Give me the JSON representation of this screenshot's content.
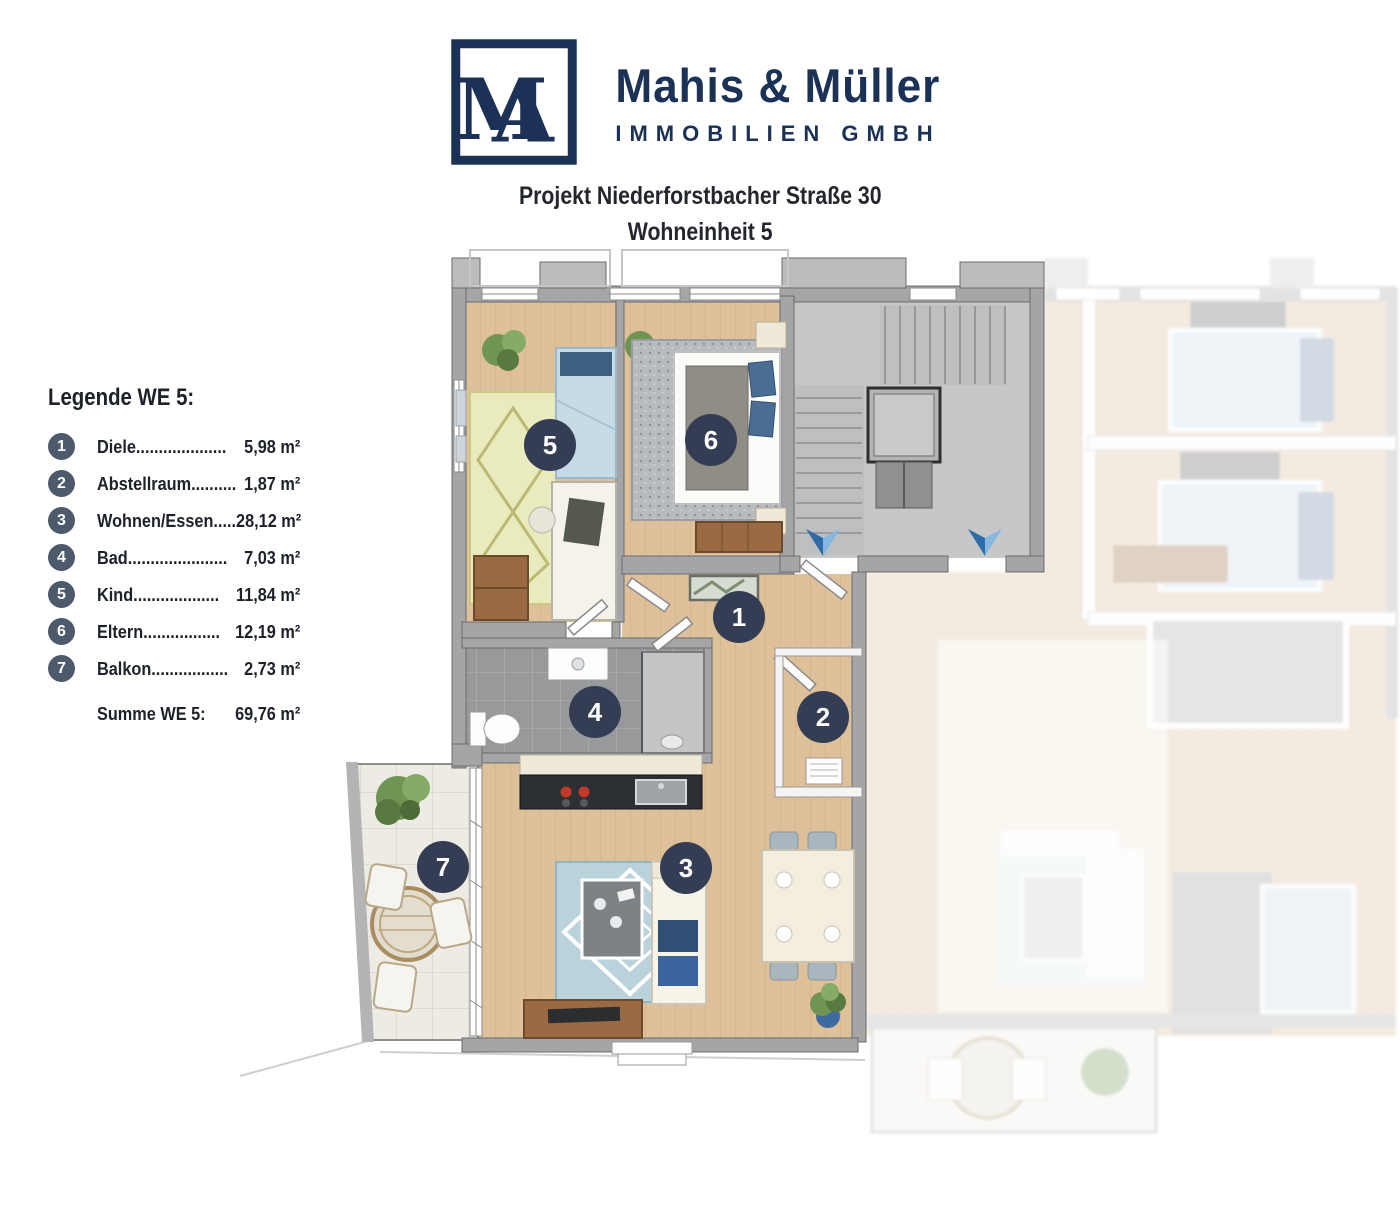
{
  "brand": {
    "name": "Mahis & Müller",
    "subtitle": "IMMOBILIEN GMBH",
    "monogram": {
      "m": "M",
      "a": "A"
    },
    "brand_color": "#1b3156"
  },
  "header": {
    "project_line1": "Projekt Niederforstbacher Straße 30",
    "project_line2": "Wohneinheit 5"
  },
  "legend": {
    "title": "Legende WE 5:",
    "badge_color": "#4d5a6c",
    "items": [
      {
        "num": "1",
        "label": "Diele",
        "dots": "....................",
        "value": "5,98 m²"
      },
      {
        "num": "2",
        "label": "Abstellraum",
        "dots": "..........",
        "value": "1,87 m²"
      },
      {
        "num": "3",
        "label": "Wohnen/Essen",
        "dots": ".....",
        "value": "28,12 m²"
      },
      {
        "num": "4",
        "label": "Bad",
        "dots": "......................",
        "value": "7,03 m²"
      },
      {
        "num": "5",
        "label": "Kind",
        "dots": "...................",
        "value": "11,84 m²"
      },
      {
        "num": "6",
        "label": "Eltern",
        "dots": ".................",
        "value": "12,19 m²"
      },
      {
        "num": "7",
        "label": "Balkon",
        "dots": ".................",
        "value": "2,73 m²"
      }
    ],
    "summary_label": "Summe WE 5:",
    "summary_value": "69,76 m²"
  },
  "floorplan": {
    "unit_label": "WE 5",
    "badge_color": "#343d53",
    "room_badges": [
      {
        "num": "1",
        "room": "Diele"
      },
      {
        "num": "2",
        "room": "Abstellraum"
      },
      {
        "num": "3",
        "room": "Wohnen/Essen"
      },
      {
        "num": "4",
        "room": "Bad"
      },
      {
        "num": "5",
        "room": "Kind"
      },
      {
        "num": "6",
        "room": "Eltern"
      },
      {
        "num": "7",
        "room": "Balkon"
      }
    ],
    "palette": {
      "wood_floor": "#dec09a",
      "wall_gray": "#a4a5a7",
      "stair_floor": "#c5c7c9",
      "bath_tile": "#97999b",
      "balcony_tile": "#edebe3",
      "rug_blue": "#b9d2dc",
      "bed_blue": "#c7dbe7",
      "pillow_navy": "#2f4f74",
      "furniture_wood": "#9a6b42",
      "arrow_blue": "#86b7e0",
      "plant_green": "#6f9454"
    }
  }
}
